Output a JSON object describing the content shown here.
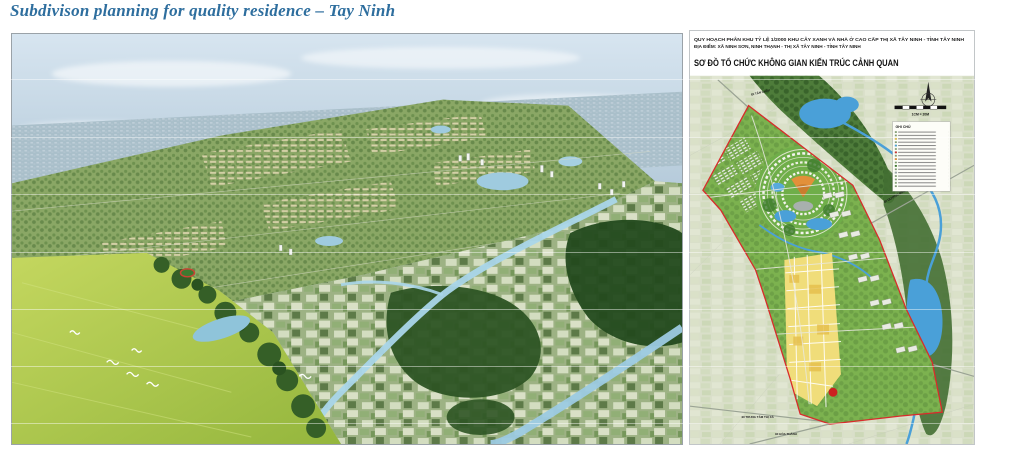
{
  "doc": {
    "title": "Subdivison planning for quality residence – Tay Ninh"
  },
  "right_figure": {
    "header_line1": "QUY HOẠCH PHÂN KHU TỶ LỆ 1/2000 KHU CÂY XANH VÀ NHÀ Ở CAO CẤP THỊ XÃ TÂY NINH - TỈNH TÂY NINH",
    "header_line2": "ĐỊA ĐIỂM: XÃ NINH SƠN, NINH THẠNH - THỊ XÃ TÂY NINH - TỈNH TÂY NINH",
    "header_line3": "SƠ ĐỒ TỔ CHỨC KHÔNG GIAN KIẾN TRÚC CẢNH QUAN",
    "legend_title": "GHI CHÚ",
    "scale_label": "1CM = 20M",
    "road_labels": {
      "tan_chau": "ĐI TÂN CHÂU",
      "duong_minh_chau": "ĐI DƯƠNG MINH CHÂU",
      "trung_tam_thi_xa": "ĐI TRUNG TÂM THỊ XÃ",
      "hoa_thanh": "ĐI HÒA THÀNH"
    }
  },
  "colors": {
    "title_blue": "#2e6e9e",
    "boundary_red": "#d92b2b",
    "water_blue": "#4aa0d8",
    "plan_yellow": "#f0dd7a",
    "park_green": "#7cb24f",
    "forest_green": "#2d5424"
  }
}
